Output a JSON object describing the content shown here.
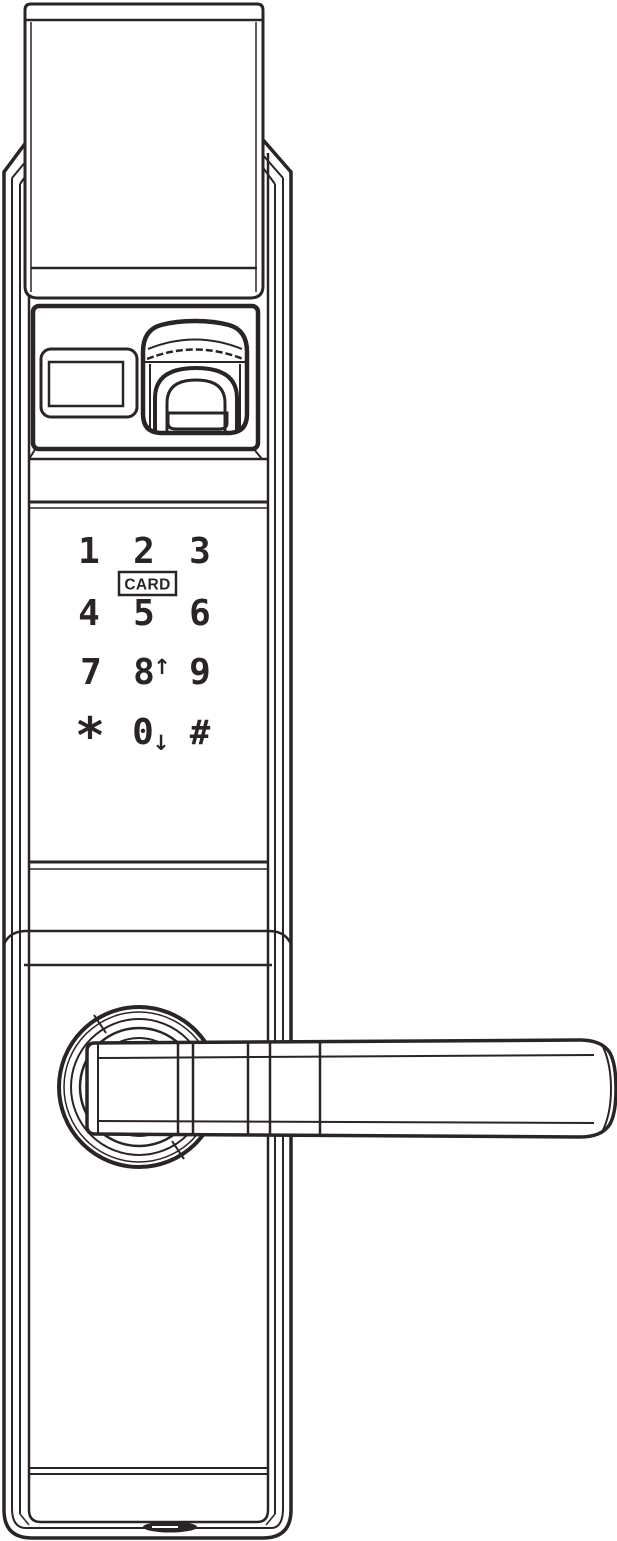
{
  "colors": {
    "line": "#2b2425",
    "background": "#ffffff"
  },
  "keypad": {
    "keys": {
      "k1": "1",
      "k2": "2",
      "k3": "3",
      "k4": "4",
      "k5": "5",
      "k6": "6",
      "k7": "7",
      "k8": "8",
      "k9": "9",
      "kstar": "*",
      "k0": "0",
      "khash": "#"
    },
    "card_label": "CARD",
    "arrow_up": "↑",
    "arrow_down": "↓"
  }
}
